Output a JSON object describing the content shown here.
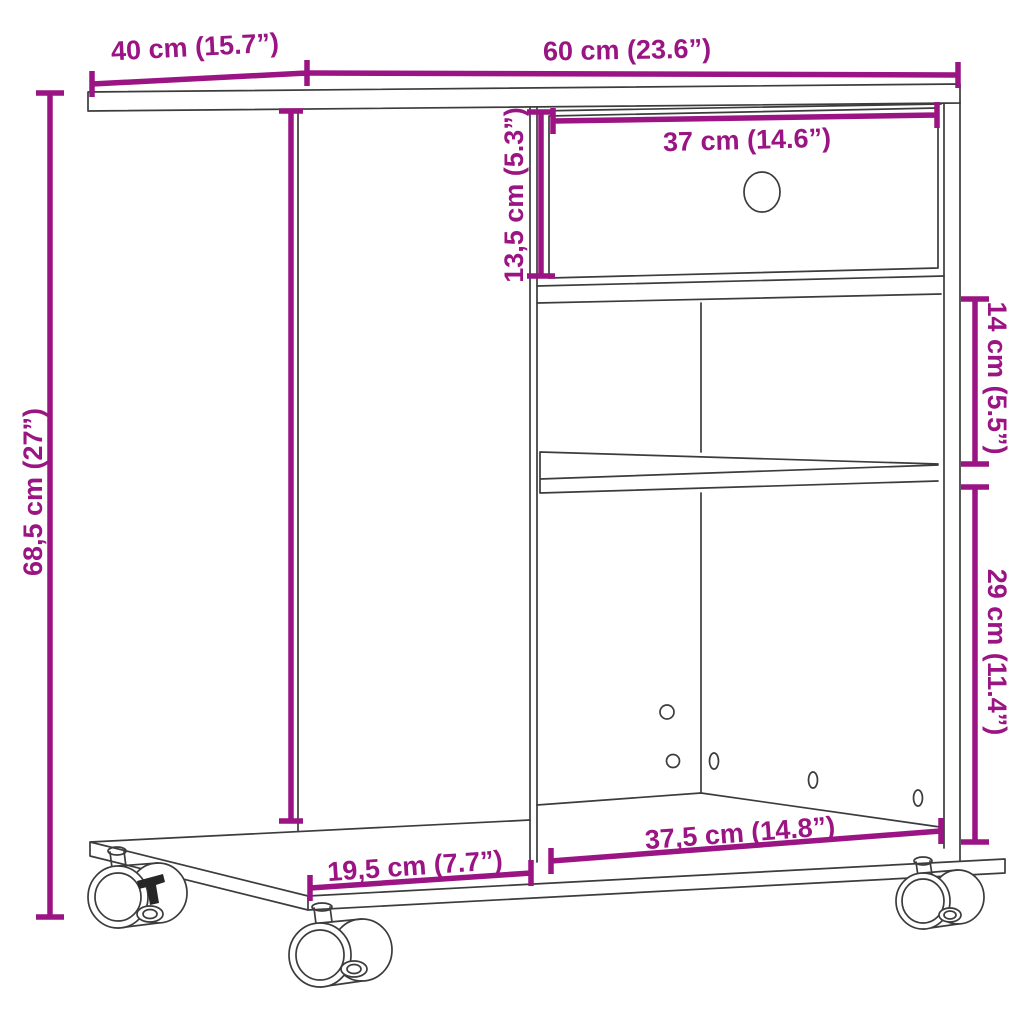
{
  "diagram": {
    "kind": "furniture-dimension-drawing",
    "product": "Rolling printer stand / side table with drawer, shelf and casters",
    "background": "#ffffff",
    "colors": {
      "dimension": "#9A1483",
      "outline": "#3C3C3C"
    },
    "dimensions": [
      {
        "id": "top-depth",
        "label": "40 cm (15.7”)",
        "cm": 40,
        "inch": 15.7
      },
      {
        "id": "top-width",
        "label": "60 cm (23.6”)",
        "cm": 60,
        "inch": 23.6
      },
      {
        "id": "drawer-width",
        "label": "37 cm (14.6”)",
        "cm": 37,
        "inch": 14.6
      },
      {
        "id": "drawer-height",
        "label": "13,5 cm (5.3”)",
        "cm": 13.5,
        "inch": 5.3
      },
      {
        "id": "middle-shelf-gap",
        "label": "14 cm (5.5”)",
        "cm": 14,
        "inch": 5.5
      },
      {
        "id": "lower-compartment",
        "label": "29 cm (11.4”)",
        "cm": 29,
        "inch": 11.4
      },
      {
        "id": "overall-height",
        "label": "68,5 cm (27”)",
        "cm": 68.5,
        "inch": 27
      },
      {
        "id": "base-front-width",
        "label": "37,5 cm (14.8”)",
        "cm": 37.5,
        "inch": 14.8
      },
      {
        "id": "base-side-depth",
        "label": "19,5 cm (7.7”)",
        "cm": 19.5,
        "inch": 7.7
      }
    ]
  }
}
